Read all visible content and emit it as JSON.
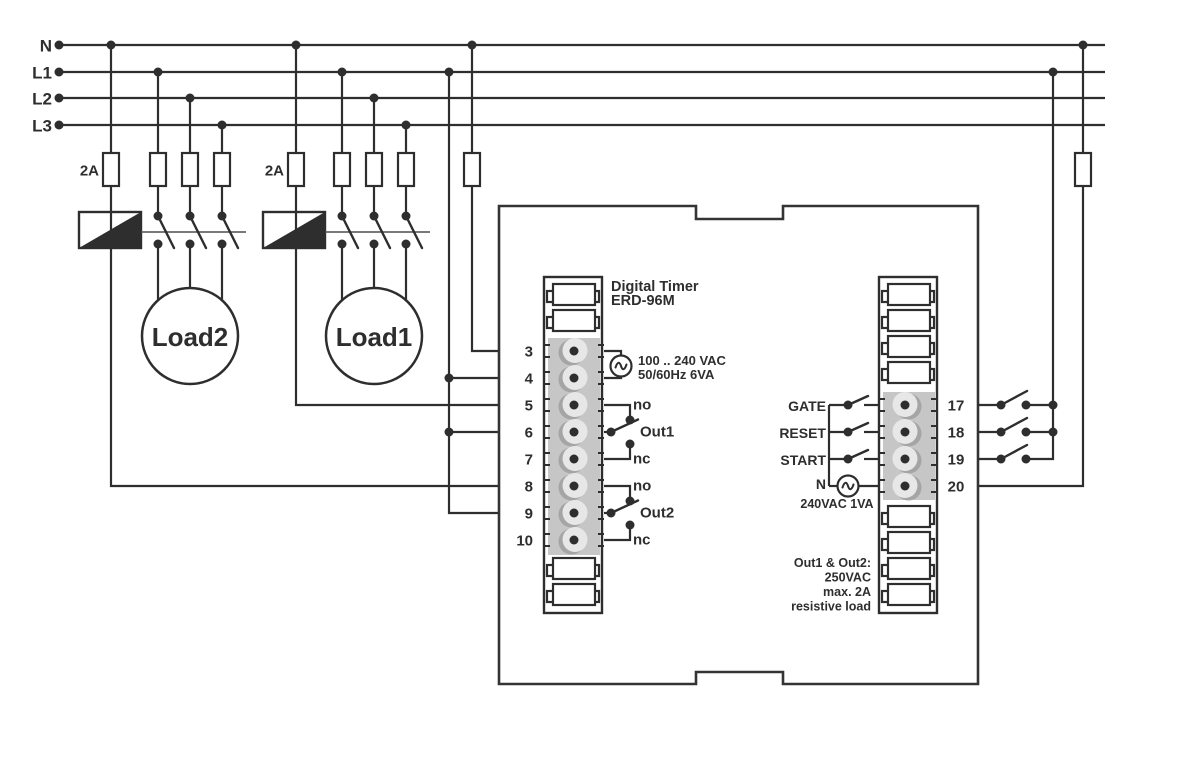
{
  "colors": {
    "wire": "#2e2e2e",
    "background": "#ffffff",
    "terminal_strip": "#c6c6c6",
    "terminal_clamp": "#e7e7e7",
    "terminal_shadow": "#a5a5a5"
  },
  "rails": {
    "n": "N",
    "l1": "L1",
    "l2": "L2",
    "l3": "L3"
  },
  "fuse": {
    "rating": "2A"
  },
  "loads": {
    "load1": "Load1",
    "load2": "Load2"
  },
  "timer": {
    "name": "Digital Timer",
    "model": "ERD-96M",
    "supply": {
      "range": "100 .. 240 VAC",
      "freq": "50/60Hz 6VA"
    },
    "left_terminals": [
      "3",
      "4",
      "5",
      "6",
      "7",
      "8",
      "9",
      "10"
    ],
    "right_terminals": [
      "17",
      "18",
      "19",
      "20"
    ],
    "out1": {
      "no": "no",
      "label": "Out1",
      "nc": "nc"
    },
    "out2": {
      "no": "no",
      "label": "Out2",
      "nc": "nc"
    },
    "inputs": {
      "gate": "GATE",
      "reset": "RESET",
      "start": "START",
      "neutral": "N",
      "rating": "240VAC 1VA"
    },
    "note": {
      "line1": "Out1 & Out2:",
      "line2": "250VAC",
      "line3": "max. 2A",
      "line4": "resistive load"
    }
  }
}
